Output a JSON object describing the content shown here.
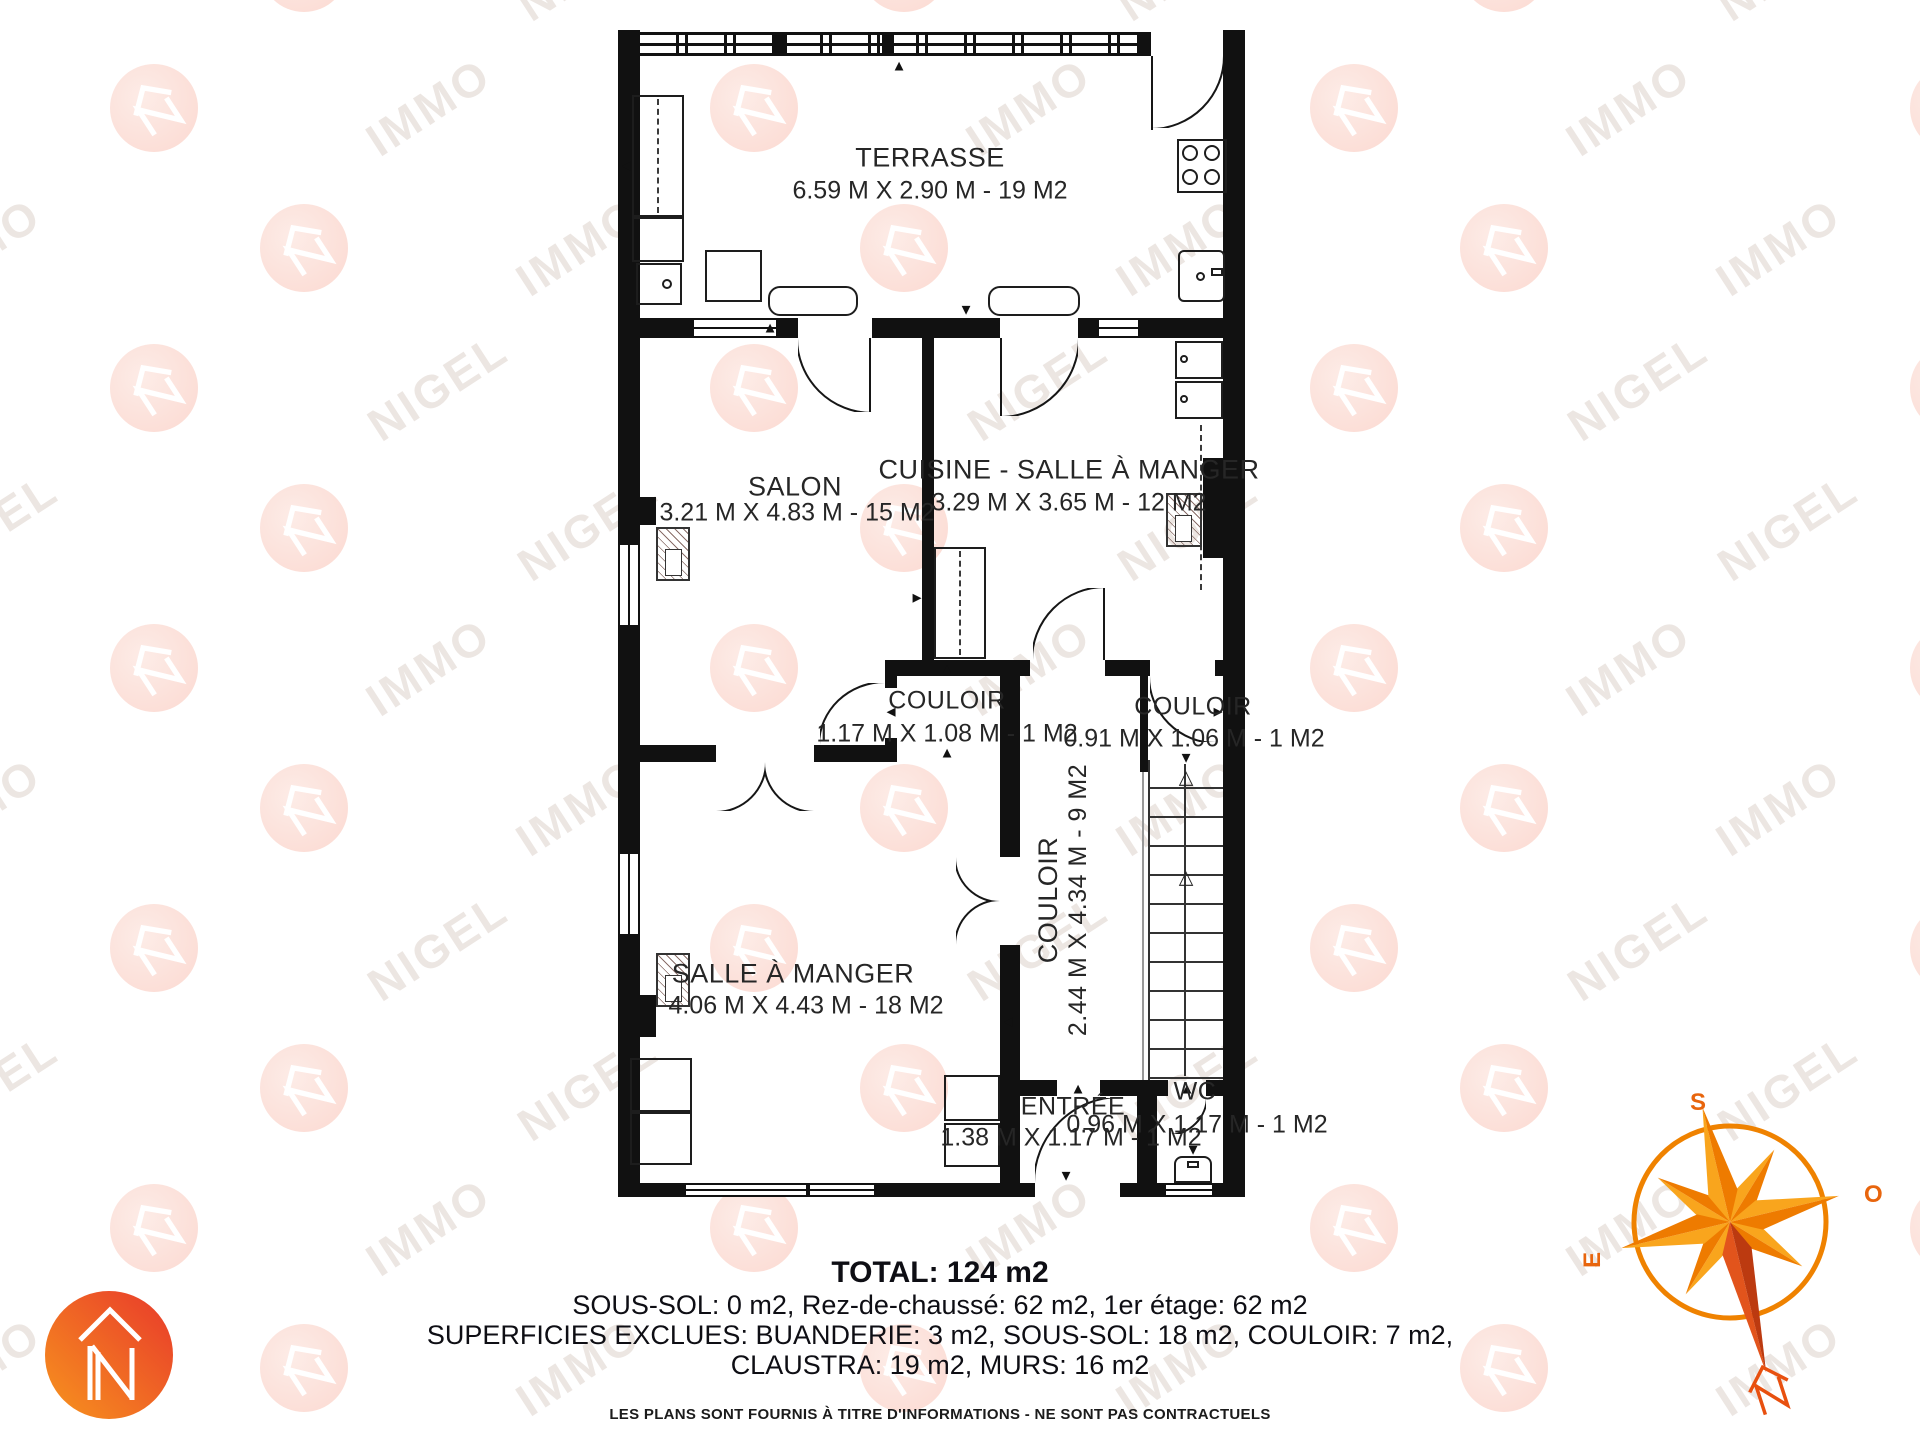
{
  "watermark": {
    "words": [
      "NIGEL",
      "IMMO"
    ]
  },
  "icons": {
    "up": "▲",
    "down": "▼",
    "left": "◄",
    "right": "►",
    "up_open": "△",
    "logo": "nigel-immo-n-house",
    "compass": "compass-rose"
  },
  "rooms": [
    {
      "id": "terrasse",
      "name": "TERRASSE",
      "dims": "6.59 M X 2.90 M - 19 M2"
    },
    {
      "id": "salon",
      "name": "SALON",
      "dims": "3.21 M X 4.83 M - 15 M2"
    },
    {
      "id": "cuisine",
      "name": "CUISINE - SALLE À MANGER",
      "dims": "3.29 M X 3.65 M - 12 M2"
    },
    {
      "id": "couloir-1",
      "name": "COULOIR",
      "dims": "1.17 M X 1.08 M - 1 M2"
    },
    {
      "id": "couloir-2",
      "name": "COULOIR",
      "dims": "0.91 M X 1.06 M - 1 M2"
    },
    {
      "id": "couloir-3",
      "name": "COULOIR",
      "dims": "2.44 M X 4.34 M - 9 M2"
    },
    {
      "id": "salle-a-manger",
      "name": "SALLE À MANGER",
      "dims": "4.06 M X 4.43 M - 18 M2"
    },
    {
      "id": "entree",
      "name": "ENTRÉE",
      "dims": "1.38 M X 1.17 M - 1 M2"
    },
    {
      "id": "wc",
      "name": "WC",
      "dims": "0.96 M X 1.17 M - 1 M2"
    }
  ],
  "summary": {
    "total": "TOTAL: 124 m2",
    "line1": "SOUS-SOL: 0 m2, Rez-de-chaussé: 62 m2, 1er étage: 62 m2",
    "line2": "SUPERFICIES EXCLUES: BUANDERIE: 3 m2, SOUS-SOL: 18 m2, COULOIR: 7 m2,",
    "line3": "CLAUSTRA: 19 m2, MURS: 16 m2",
    "disclaimer": "LES PLANS SONT FOURNIS À TITRE D'INFORMATIONS - NE SONT PAS CONTRACTUELS"
  },
  "compass": {
    "south": "S",
    "west": "O",
    "east": "E",
    "north": "N"
  },
  "colors": {
    "wall": "#111111",
    "accent_orange": "#F7941E",
    "accent_red": "#E8392B",
    "compass_light": "#F9A51D",
    "compass_dark": "#EE7B00",
    "compass_red_light": "#E2541C",
    "compass_red_dark": "#BC3A10",
    "compass_letter": "#E8650D",
    "watermark_text": "#ECE6E2",
    "watermark_circle": "#FBD9D1"
  }
}
